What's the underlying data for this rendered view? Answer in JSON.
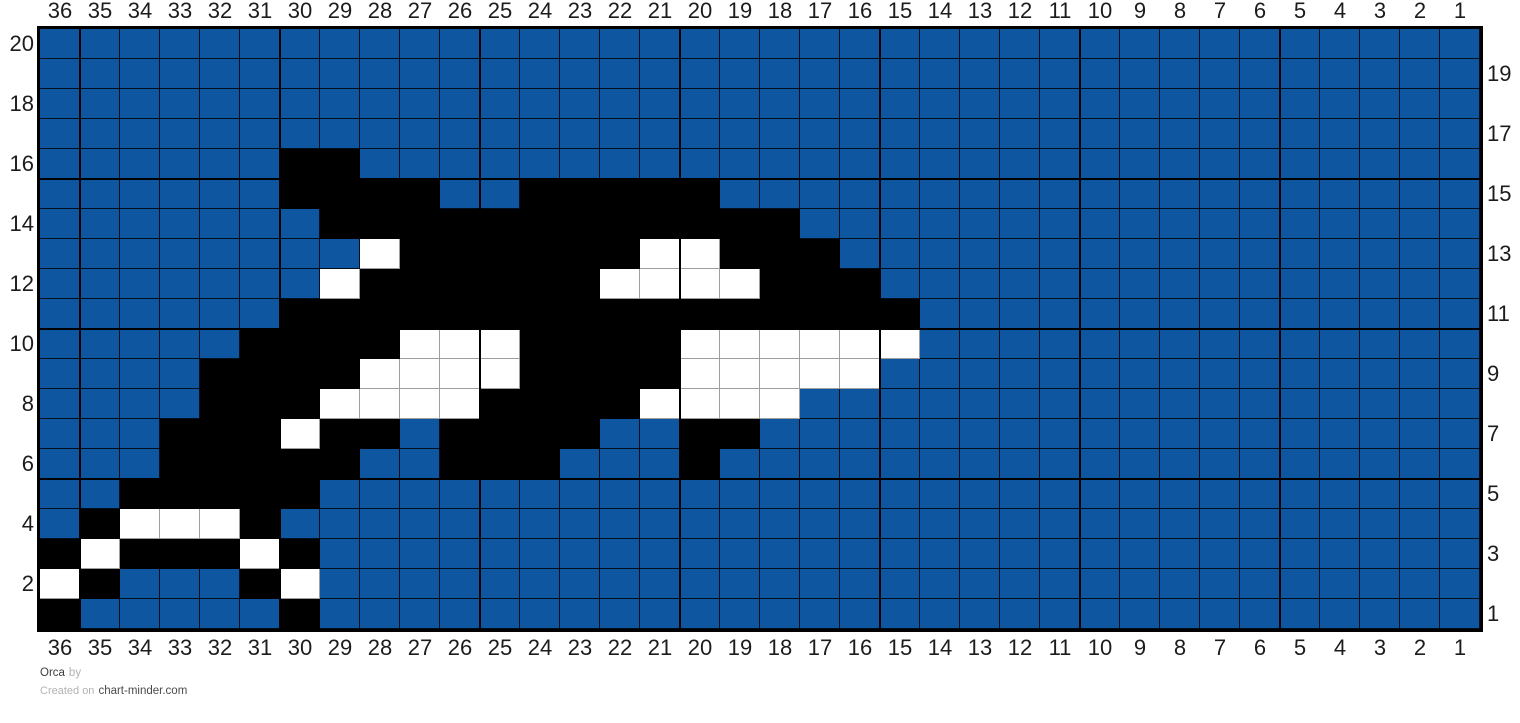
{
  "footer": {
    "pattern_name": "Orca",
    "by_label": "by",
    "created_on_label": "Created on",
    "site": "chart-minder.com"
  },
  "chart_data": {
    "type": "heatmap",
    "title": "Orca",
    "columns": [
      36,
      35,
      34,
      33,
      32,
      31,
      30,
      29,
      28,
      27,
      26,
      25,
      24,
      23,
      22,
      21,
      20,
      19,
      18,
      17,
      16,
      15,
      14,
      13,
      12,
      11,
      10,
      9,
      8,
      7,
      6,
      5,
      4,
      3,
      2,
      1
    ],
    "rows": [
      20,
      19,
      18,
      17,
      16,
      15,
      14,
      13,
      12,
      11,
      10,
      9,
      8,
      7,
      6,
      5,
      4,
      3,
      2,
      1
    ],
    "column_labels_position": "top and bottom",
    "row_labels_position": "even rows left, odd rows right",
    "major_grid_every": 5,
    "palette": {
      "B": "#0e56a0",
      "K": "#000000",
      "W": "#ffffff"
    },
    "legend": {
      "B": "ocean blue background",
      "K": "black (orca body)",
      "W": "white (orca markings)"
    },
    "grid_rle": [
      "36B",
      "36B",
      "36B",
      "36B",
      "6B2K28B",
      "6B4K2B5K19B",
      "7B12K17B",
      "8B1W6K2W3K16B",
      "7B1W6K4W3K15B",
      "6B16K14B",
      "5B4K3W4K6W14B",
      "4B4K4W4K5W15B",
      "4B3K4W4K4W17B",
      "3B3K1W2K1B4K2B2K18B",
      "3B5K2B3K3B1K19B",
      "2B5K29B",
      "1B1K3W1K30B",
      "1K1W3K1W1K29B",
      "1W1K3B1K1W29B",
      "1K5B1K29B"
    ]
  }
}
